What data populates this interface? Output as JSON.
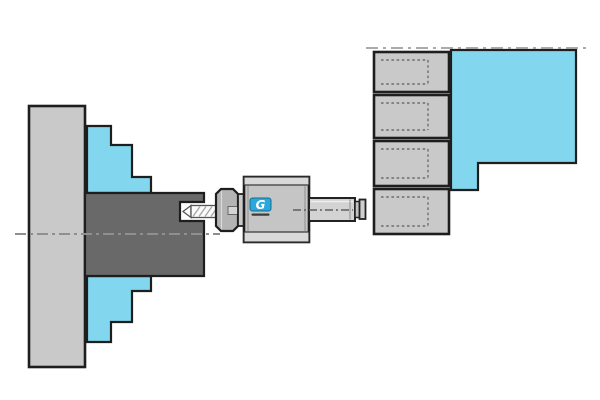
{
  "scene": {
    "logo": {
      "letter": "G"
    },
    "colors": {
      "background": "#ffffff",
      "outline": "#1e1e1e",
      "machine_gray": "#c9c9c9",
      "fixture_cyan": "#82d7ee",
      "workpiece_gray": "#696969",
      "holder_face_gray": "#c5c5c5",
      "holder_cap_gray": "#d9d9d9",
      "collet_nut_gray": "#b4b4b4",
      "nut_slot_gray": "#d4d4d4",
      "shank_gray": "#d3d3d3",
      "drill_white": "#fbfbfb",
      "logo_blue": "#2ba7da",
      "centerline_gray": "#8f8f8f",
      "tool_axis_gray": "#5f5f5f",
      "ref_line_gray": "#9e9e9e",
      "pocket_dash_gray": "#6e6e6e",
      "wordmark_dark": "#3c3c3c"
    },
    "components": {
      "left": [
        "chuck-backplate",
        "chuck-jaw-top",
        "chuck-jaw-bottom",
        "workpiece"
      ],
      "center": [
        "drill-bit",
        "collet-nut",
        "toolholder-body",
        "toolholder-shank",
        "brand-logo"
      ],
      "right": [
        "turret-station-1",
        "turret-station-2",
        "turret-station-3",
        "turret-station-4",
        "turret-body-fixture"
      ],
      "reference_lines": [
        "spindle-centerline",
        "tool-axis-centerline",
        "turret-reference-line"
      ]
    }
  }
}
